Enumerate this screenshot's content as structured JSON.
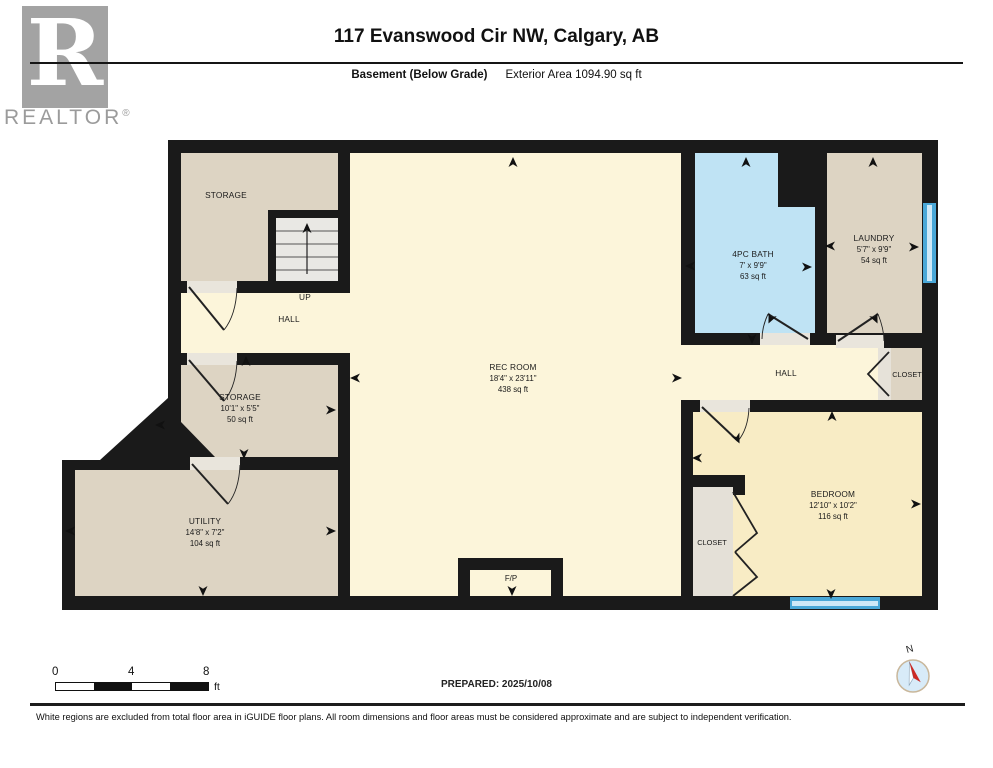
{
  "header": {
    "title": "117 Evanswood Cir NW, Calgary, AB",
    "floor_label": "Basement (Below Grade)",
    "area_label": "Exterior Area 1094.90 sq ft"
  },
  "branding": {
    "logo_letter": "R",
    "logo_text": "REALTOR",
    "registered_mark": "®"
  },
  "rooms": {
    "storage_upper": {
      "name": "STORAGE"
    },
    "stairs": {
      "up_label": "UP"
    },
    "hall_upper": {
      "name": "HALL"
    },
    "rec_room": {
      "name": "REC ROOM",
      "dims": "18'4\" x 23'11\"",
      "area": "438 sq ft"
    },
    "bath": {
      "name": "4PC BATH",
      "dims": "7' x 9'9\"",
      "area": "63 sq ft"
    },
    "laundry": {
      "name": "LAUNDRY",
      "dims": "5'7\" x 9'9\"",
      "area": "54 sq ft"
    },
    "closet_hall": {
      "name": "CLOSET"
    },
    "hall_right": {
      "name": "HALL"
    },
    "storage_mid": {
      "name": "STORAGE",
      "dims": "10'1\" x 5'5\"",
      "area": "50 sq ft"
    },
    "utility": {
      "name": "UTILITY",
      "dims": "14'8\" x 7'2\"",
      "area": "104 sq ft"
    },
    "bedroom": {
      "name": "BEDROOM",
      "dims": "12'10\" x 10'2\"",
      "area": "116 sq ft"
    },
    "closet_bedroom": {
      "name": "CLOSET"
    },
    "fireplace": {
      "name": "F/P"
    }
  },
  "scale_bar": {
    "tick0": "0",
    "tick4": "4",
    "tick8": "8",
    "unit": "ft"
  },
  "compass": {
    "north_label": "N"
  },
  "footer": {
    "prepared": "PREPARED: 2025/10/08",
    "disclaimer": "White regions are excluded from total floor area in iGUIDE floor plans. All room dimensions and floor areas must be considered approximate and are subject to independent verification."
  },
  "colors": {
    "wall": "#1a1a1a",
    "floor_cream": "#fcf5da",
    "room_beige": "#ddd4c3",
    "bath_blue": "#bfe3f4",
    "bedroom_cream": "#f8ecc5",
    "closet_gray": "#e4e0d7",
    "stairs_gray": "#e9e8e4",
    "window_blue": "#4aa8d8",
    "logo_gray": "#a3a3a3"
  }
}
